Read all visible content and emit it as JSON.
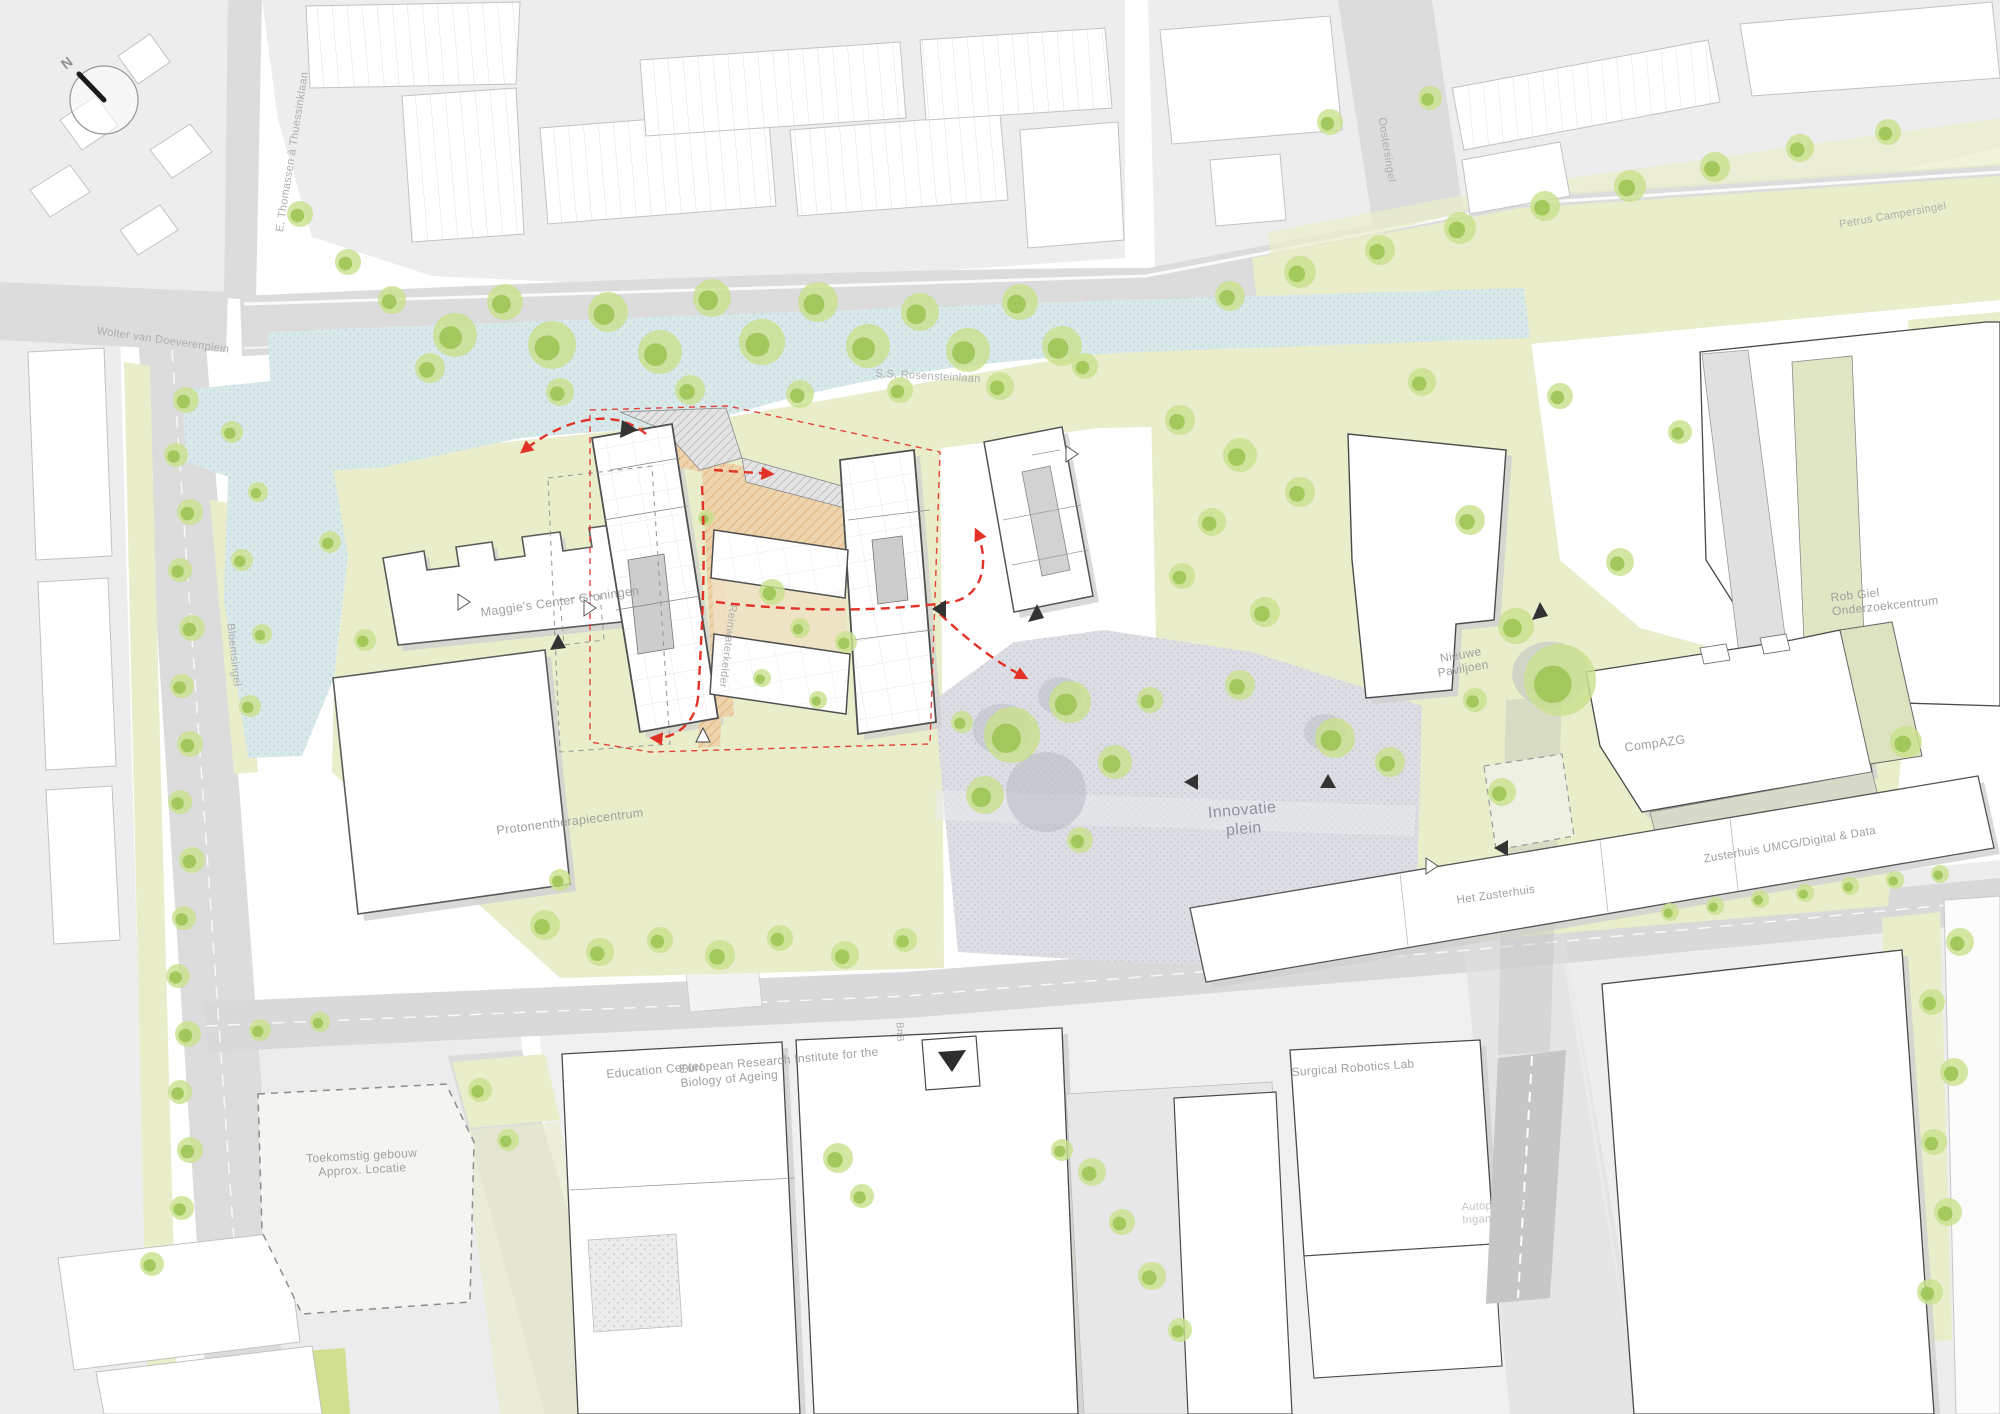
{
  "title": "Healthy Ageing Campus site plan",
  "compass": {
    "north_label": "N"
  },
  "labels": {
    "thomassen": "E. Thomassen à Thuessinklaan",
    "wolter": "Wolter van Doeverenplein",
    "rosenstein": "S.S. Rosensteinlaan",
    "campersingel": "Petrus Campersingel",
    "oostersingel": "Oostersingel",
    "bloemsingel": "Bloemsingel",
    "bnb": "BnB",
    "maggies": "Maggie's Center Groningen",
    "reinwaterkelder": "Reinwaterkelder",
    "protonen": "Protonentherapiecentrum",
    "innovatie": "Innovatie plein",
    "nieuwe_paviljoen": "Nieuwe Paviljoen",
    "compazg": "CompAZG",
    "robgiel": "Rob Giel Onderzoekcentrum",
    "zusterhuis_umcg": "Zusterhuis UMCG/Digital & Data",
    "het_zusterhuis": "Het Zusterhuis",
    "education": "Education Center",
    "eriba": "European Research Institute for the Biology of Ageing",
    "surgical": "Surgical Robotics Lab",
    "toekomstig": "Toekomstig gebouw Approx. Locatie",
    "autoparkeren": "Autoparkeren Ingang"
  },
  "colors": {
    "water": "#d9e8e9",
    "greenery": "#e9edca",
    "tree": "#9dc556",
    "road": "#dcdcdc",
    "building_outline": "#4f4f4f",
    "route_red": "#e23227",
    "courtyard_orange": "#eed4ad",
    "plaza": "#dcdee3",
    "label_gray": "#a2a2a2"
  }
}
